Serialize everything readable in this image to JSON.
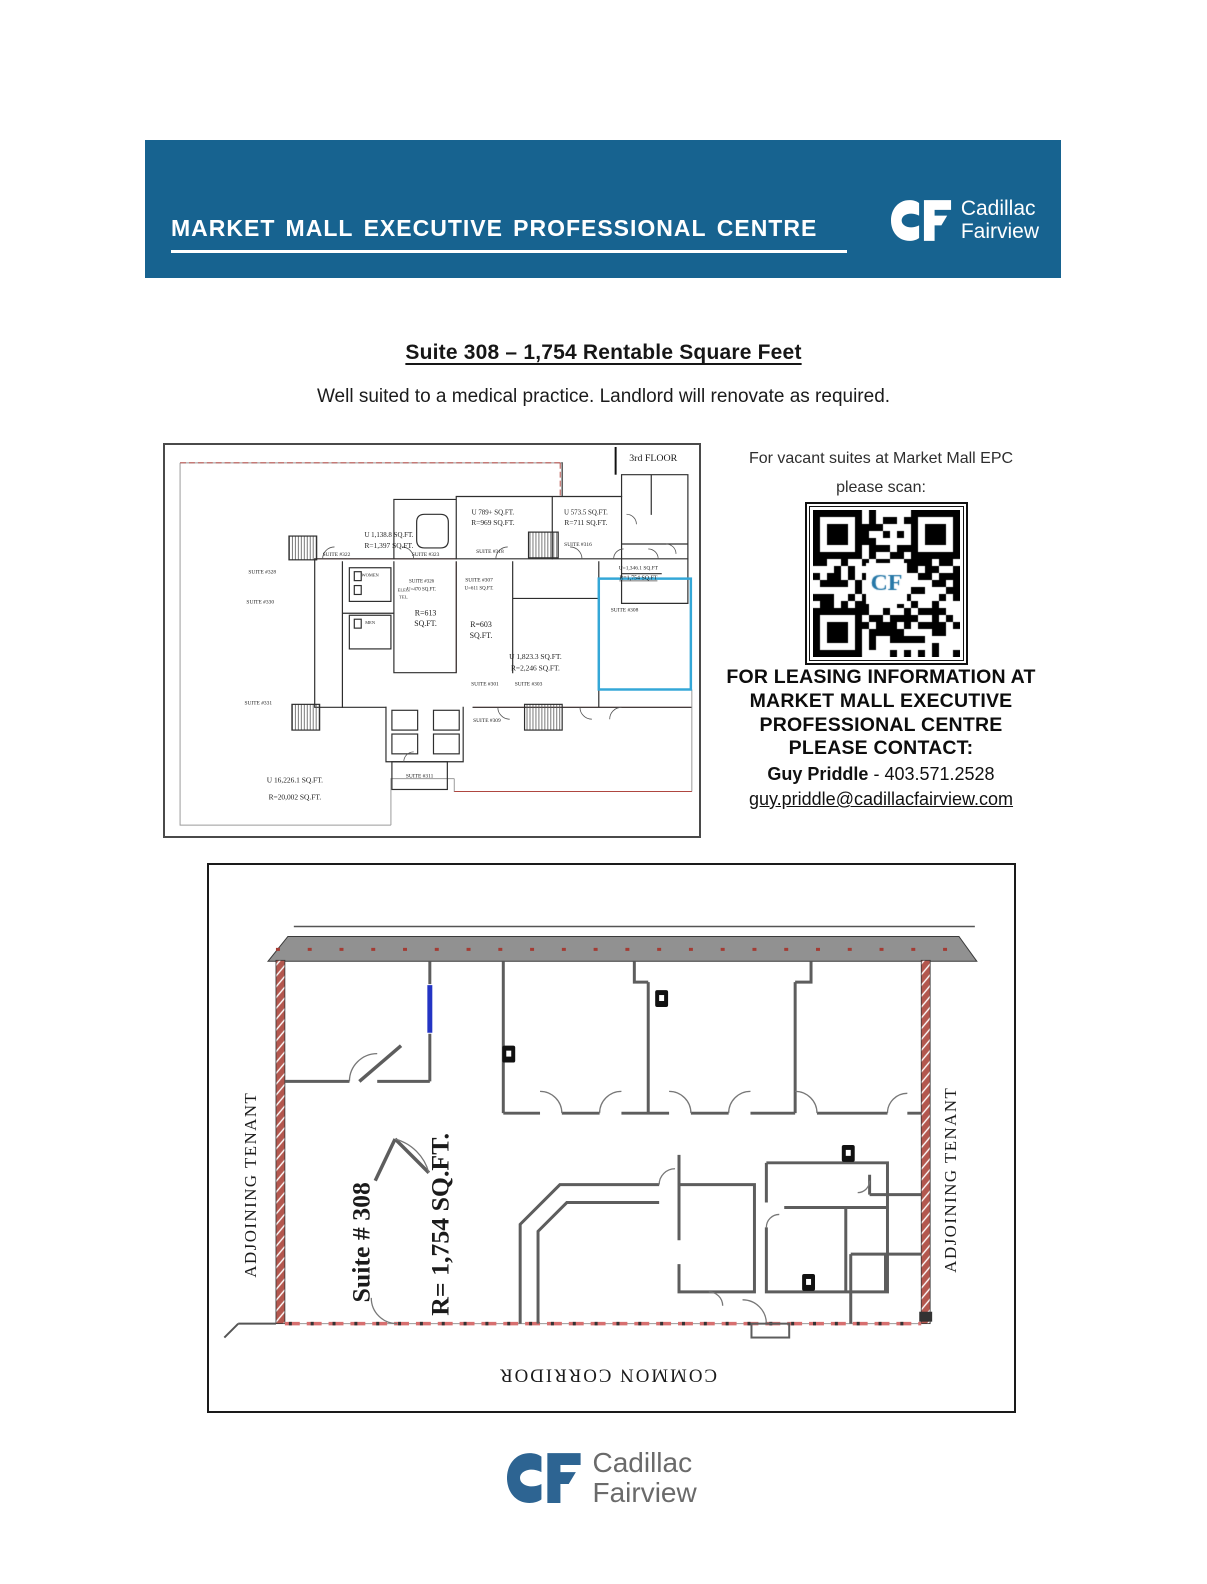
{
  "colors": {
    "banner_blue": "#176390",
    "highlight_cyan": "#34a7d7",
    "wall_red": "#b3574e",
    "logo_blue": "#2d6492",
    "door_blue": "#2334c4",
    "qr_blue": "#2678a8",
    "plan_red": "#b23b34"
  },
  "header": {
    "banner_title": "Market Mall Executive Professional Centre",
    "logo": {
      "line1": "Cadillac",
      "line2": "Fairview"
    }
  },
  "headline": {
    "title": "Suite 308 – 1,754 Rentable Square Feet",
    "subtitle": "Well suited to a medical practice. Landlord will renovate as required."
  },
  "scan": {
    "line1": "For vacant suites at Market Mall EPC",
    "line2": "please scan:",
    "qr_label": "CF"
  },
  "leasing": {
    "line1": "FOR LEASING INFORMATION AT",
    "line2": "MARKET MALL EXECUTIVE",
    "line3": "PROFESSIONAL CENTRE",
    "line4": "PLEASE CONTACT:",
    "contact_name": "Guy Priddle",
    "contact_rest": " - 403.571.2528",
    "contact_email": "guy.priddle@cadillacfairview.com"
  },
  "small_plan": {
    "floor_label": "3rd FLOOR",
    "labels": [
      {
        "t": "U 789+ SQ.FT.",
        "x": 330,
        "y": 70,
        "s": 7
      },
      {
        "t": "R=969 SQ.FT.",
        "x": 330,
        "y": 81,
        "s": 7.5
      },
      {
        "t": "U 573.5 SQ.FT.",
        "x": 424,
        "y": 70,
        "s": 7
      },
      {
        "t": "R=711 SQ.FT.",
        "x": 424,
        "y": 81,
        "s": 7.5
      },
      {
        "t": "U 1,138.8 SQ.FT.",
        "x": 225,
        "y": 93,
        "s": 7
      },
      {
        "t": "R=1,397 SQ.FT.",
        "x": 225,
        "y": 104,
        "s": 7.5
      },
      {
        "t": "SUITE #318",
        "x": 327,
        "y": 109,
        "s": 5.5
      },
      {
        "t": "SUITE #316",
        "x": 416,
        "y": 102,
        "s": 5.5
      },
      {
        "t": "SUITE #322",
        "x": 172,
        "y": 112,
        "s": 5.5
      },
      {
        "t": "SUITE #323",
        "x": 262,
        "y": 112,
        "s": 5.5
      },
      {
        "t": "SUITE #328",
        "x": 97,
        "y": 130,
        "s": 5.5
      },
      {
        "t": "SUITE #330",
        "x": 95,
        "y": 160,
        "s": 5.5
      },
      {
        "t": "WOMEN",
        "x": 206,
        "y": 133,
        "s": 4.5
      },
      {
        "t": "MEN",
        "x": 206,
        "y": 181,
        "s": 4.5
      },
      {
        "t": "ELEC.",
        "x": 240,
        "y": 148,
        "s": 4.5
      },
      {
        "t": "TEL.",
        "x": 240,
        "y": 155,
        "s": 4.5
      },
      {
        "t": "SUITE #326",
        "x": 258,
        "y": 139,
        "s": 5
      },
      {
        "t": "U=470 SQ.FT.",
        "x": 258,
        "y": 147,
        "s": 5
      },
      {
        "t": "R=613",
        "x": 262,
        "y": 172,
        "s": 8
      },
      {
        "t": "SQ.FT.",
        "x": 262,
        "y": 183,
        "s": 8
      },
      {
        "t": "SUITE #307",
        "x": 316,
        "y": 138,
        "s": 5.5
      },
      {
        "t": "U=611 SQ.FT.",
        "x": 316,
        "y": 146,
        "s": 5
      },
      {
        "t": "R=603",
        "x": 318,
        "y": 184,
        "s": 8
      },
      {
        "t": "SQ.FT.",
        "x": 318,
        "y": 195,
        "s": 8
      },
      {
        "t": "U=1,346.1 SQ.FT",
        "x": 477,
        "y": 126,
        "s": 5.5
      },
      {
        "t": "R=1,754 SQ.FT",
        "x": 477,
        "y": 136,
        "s": 6,
        "u": true
      },
      {
        "t": "SUITE #308",
        "x": 463,
        "y": 168,
        "s": 5.5
      },
      {
        "t": "U 1,823.3 SQ.FT.",
        "x": 373,
        "y": 216,
        "s": 7.5
      },
      {
        "t": "R=2,246 SQ.FT.",
        "x": 373,
        "y": 228,
        "s": 7.5
      },
      {
        "t": "SUITE #301",
        "x": 322,
        "y": 243,
        "s": 5.5
      },
      {
        "t": "SUITE #303",
        "x": 366,
        "y": 243,
        "s": 5.5
      },
      {
        "t": "SUITE #309",
        "x": 324,
        "y": 280,
        "s": 5.5
      },
      {
        "t": "SUITE #311",
        "x": 256,
        "y": 336,
        "s": 5.5
      },
      {
        "t": "SUITE #331",
        "x": 93,
        "y": 262,
        "s": 5.5
      },
      {
        "t": "U 16,226.1 SQ.FT.",
        "x": 130,
        "y": 341,
        "s": 7.5
      },
      {
        "t": "R=20,002 SQ.FT.",
        "x": 130,
        "y": 358,
        "s": 7.5
      }
    ]
  },
  "large_plan": {
    "adjoining_left": "ADJOINING TENANT",
    "adjoining_right": "ADJOINING TENANT",
    "suite_label": "Suite # 308",
    "area_label": "R= 1,754 SQ.FT.",
    "corridor_label": "COMMON CORRIDOR"
  },
  "footer": {
    "logo_line1": "Cadillac",
    "logo_line2": "Fairview"
  }
}
